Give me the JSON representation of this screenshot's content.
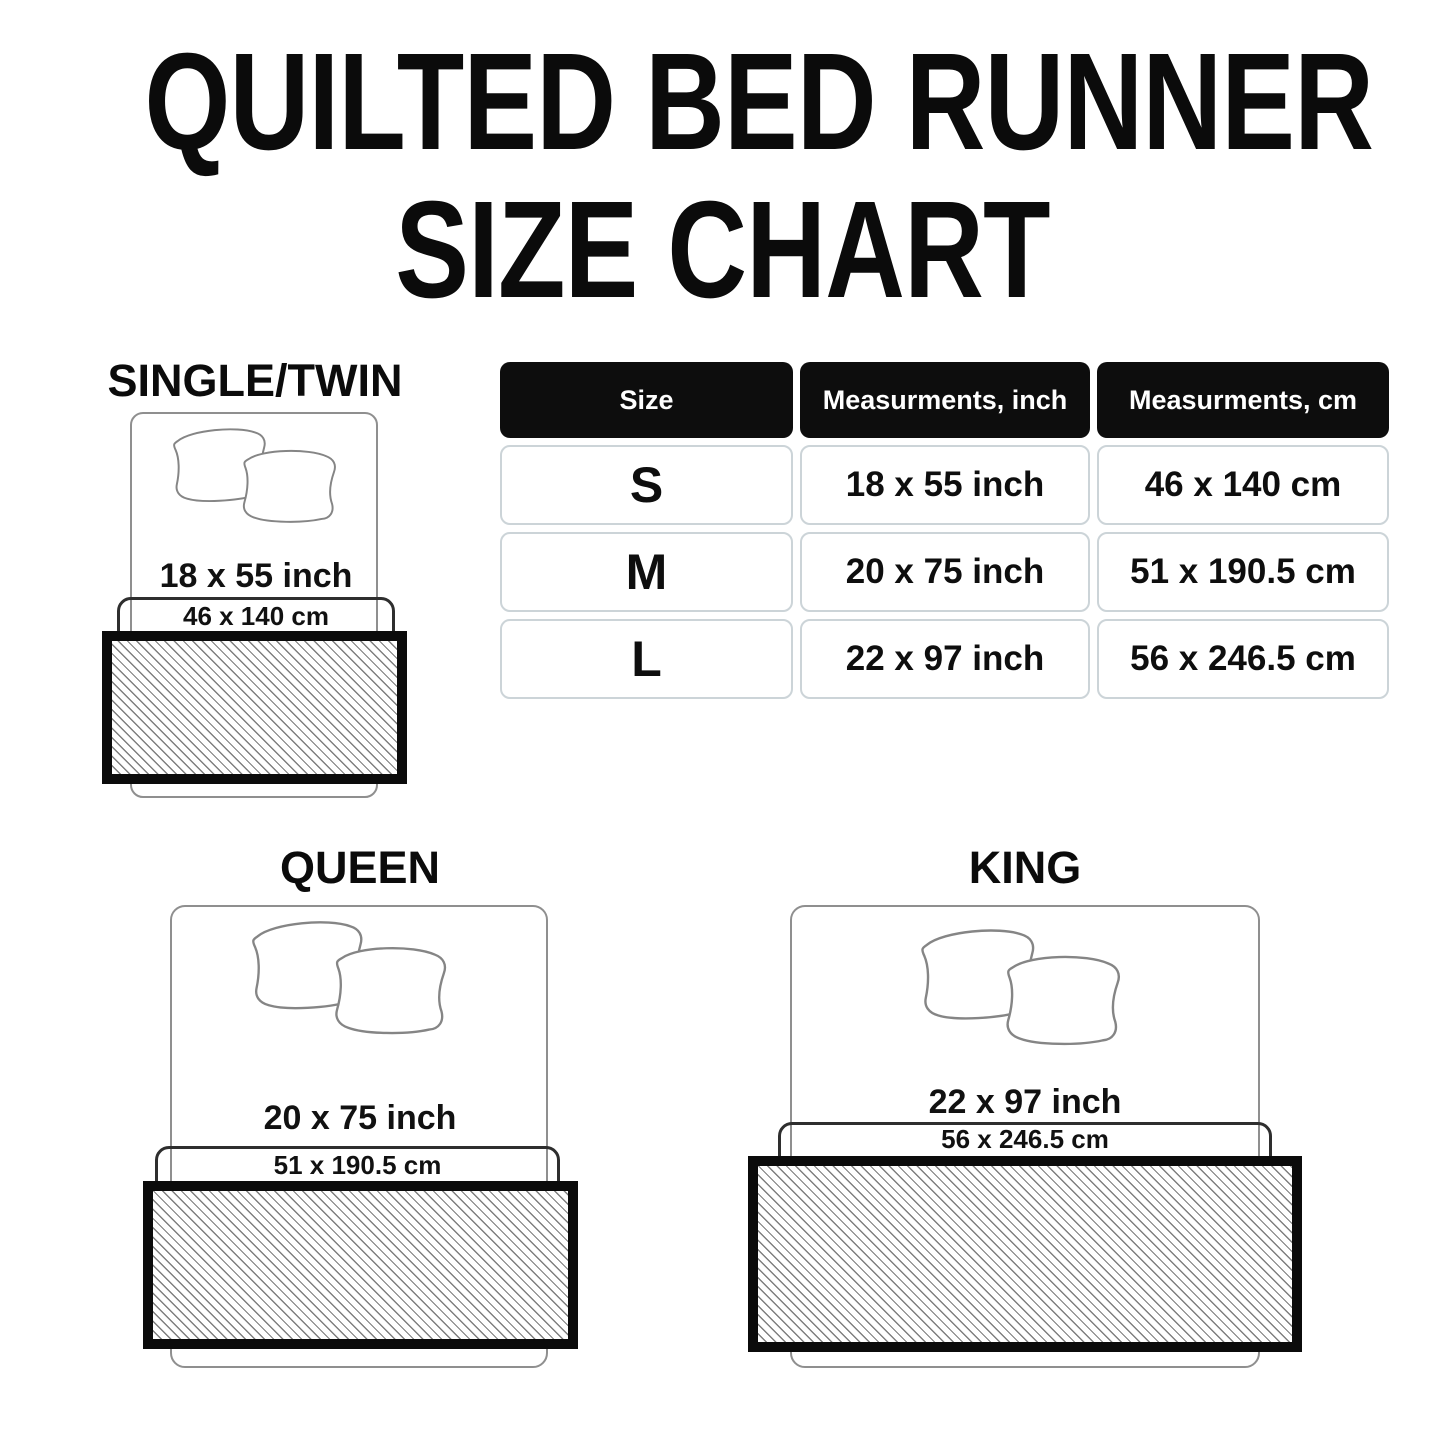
{
  "title": {
    "line1": "QUILTED BED RUNNER",
    "line2": "SIZE CHART"
  },
  "table": {
    "headers": [
      "Size",
      "Measurments, inch",
      "Measurments, cm"
    ],
    "rows": [
      {
        "size": "S",
        "inch": "18 x 55 inch",
        "cm": "46 x 140 cm"
      },
      {
        "size": "M",
        "inch": "20 x 75 inch",
        "cm": "51 x 190.5 cm"
      },
      {
        "size": "L",
        "inch": "22 x 97 inch",
        "cm": "56 x 246.5 cm"
      }
    ]
  },
  "diagrams": [
    {
      "label": "SINGLE/TWIN",
      "inch": "18 x 55 inch",
      "cm": "46 x 140 cm"
    },
    {
      "label": "QUEEN",
      "inch": "20 x 75 inch",
      "cm": "51 x 190.5 cm"
    },
    {
      "label": "KING",
      "inch": "22 x 97 inch",
      "cm": "56 x 246.5 cm"
    }
  ],
  "colors": {
    "text": "#0b0b0b",
    "table_header_bg": "#0d0d0d",
    "table_header_text": "#ffffff",
    "cell_border": "#ccd4d8",
    "bed_outline": "#8f8f8f",
    "pillow_outline": "#858585",
    "inner_box_outline": "#2e2e2e",
    "runner_border": "#0b0b0b",
    "hatch_line": "#7e7e7e"
  }
}
